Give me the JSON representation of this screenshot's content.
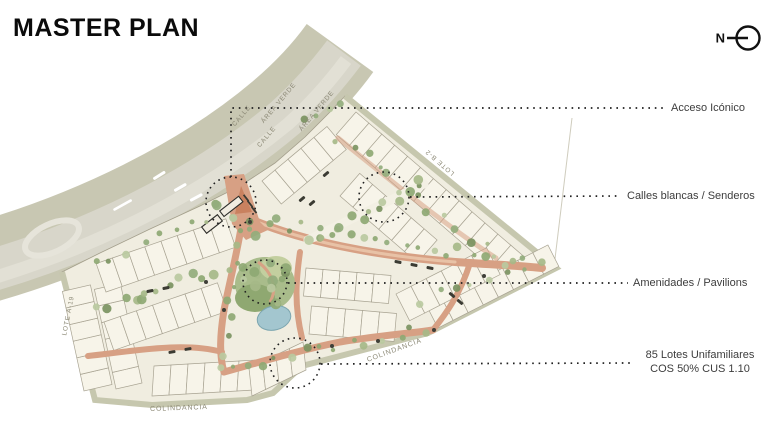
{
  "title": "MASTER PLAN",
  "north_indicator": {
    "label": "N"
  },
  "callouts": [
    {
      "label": "Acceso Icónico"
    },
    {
      "label": "Calles blancas / Senderos"
    },
    {
      "label": "Amenidades / Pavilions"
    },
    {
      "label": "85 Lotes Unifamiliares",
      "sublabel": "COS 50% CUS 1.10"
    }
  ],
  "map_labels": {
    "calle_upper": "CALLE",
    "area_verde_upper": "ÁREA VERDE",
    "calle_lower": "CALLE",
    "area_verde_lower": "ÁREA VERDE",
    "lote_b2": "LOTE B-2",
    "lote_a19": "LOTE A-19",
    "colindancia_right": "COLINDANCIA",
    "colindancia_bottom": "COLINDANCIA"
  },
  "colors": {
    "highway_base": "#c8c7b2",
    "highway_lane": "#d8d6ca",
    "highway_lane_light": "#e2e0d5",
    "site_fill": "#f0ede0",
    "site_edge_band": "#c6c7ae",
    "lot_fill": "#f7f4e9",
    "lot_line": "#a8a392",
    "street_internal": "#d7a084",
    "street_internal_light": "#e8c2a6",
    "green_1": "#8ea873",
    "green_2": "#a6b988",
    "green_3": "#7b9361",
    "green_4": "#bac9a0",
    "green_5": "#93ad7c",
    "pond": "#a3c6cf",
    "callout_text": "#3d3d3d",
    "map_label_text": "#8b8875",
    "leader": "#1f1f1f"
  }
}
